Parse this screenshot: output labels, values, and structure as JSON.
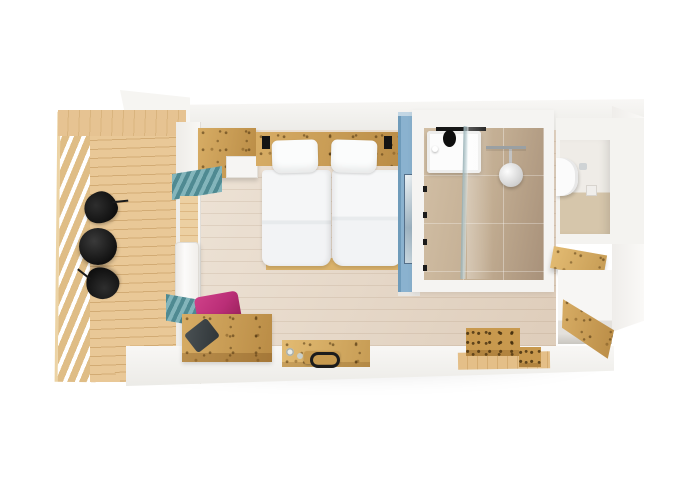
{
  "image": {
    "kind": "3d-floorplan-top-down-render",
    "subject": "compact apartment / hotel room module with balcony, bedroom, bathroom, WC and entry",
    "background": "#ffffff",
    "visible_text": ""
  },
  "palette": {
    "bg": "#ffffff",
    "wall": "#f3f2ef",
    "wall-shade": "#e4e2de",
    "wall-dark": "#d7d4cf",
    "deck": "#e6c392",
    "deck-line": "#d2ab74",
    "railing": "#dfbd86",
    "wood": "#c8994e",
    "wood-light": "#d8ad61",
    "wood-dark": "#8a6426",
    "floor": "#e7d9c8",
    "floor-line": "#cdb79c",
    "tile": "#c2ad92",
    "tile-dark": "#a8917a",
    "blue": "#8ab2cf",
    "blue-light": "#c2d6e4",
    "blue-dark": "#6e9bba",
    "teal": "#4f8a92",
    "teal-light": "#83b5bb",
    "magenta": "#ba2e77",
    "magenta-dark": "#962158",
    "black": "#1c1c1c",
    "bedding": "#f2f3f5",
    "bedding-shade": "#d9dde0",
    "pillow-dark": "#3a4043",
    "glass": "#b7cfd4"
  },
  "scene": {
    "rooms": [
      {
        "name": "balcony",
        "floor": "wood decking with slatted railing",
        "items": [
          "round-black-table",
          "black-lounge-chair",
          "black-lounge-chair"
        ]
      },
      {
        "name": "bedroom",
        "floor": "light wood planks",
        "items": [
          "wardrobe",
          "headboard-shelf",
          "twin-bed-left",
          "twin-bed-right",
          "teal-wall-radiator-upper",
          "teal-wall-radiator-lower",
          "white-balcony-door",
          "wood-bench",
          "magenta-cushion",
          "dark-grey-cushion",
          "wall-desk",
          "serving-tray",
          "drinking-glasses"
        ]
      },
      {
        "name": "bathroom",
        "floor": "beige tiles",
        "wall_accent": "light blue partition with mirror",
        "items": [
          "washbasin",
          "black-faucet-rail",
          "glass-shower-screen",
          "rain-shower-head",
          "towel-rail"
        ]
      },
      {
        "name": "wc-niche",
        "floor": "beige tiles",
        "items": [
          "wall-hung-toilet",
          "flush-plate",
          "paper-holder"
        ]
      },
      {
        "name": "entry",
        "floor": "light wood planks",
        "items": [
          "wooden-step-blocks",
          "coat-shelf",
          "storage-cabinet",
          "open-wood-door"
        ]
      }
    ]
  }
}
